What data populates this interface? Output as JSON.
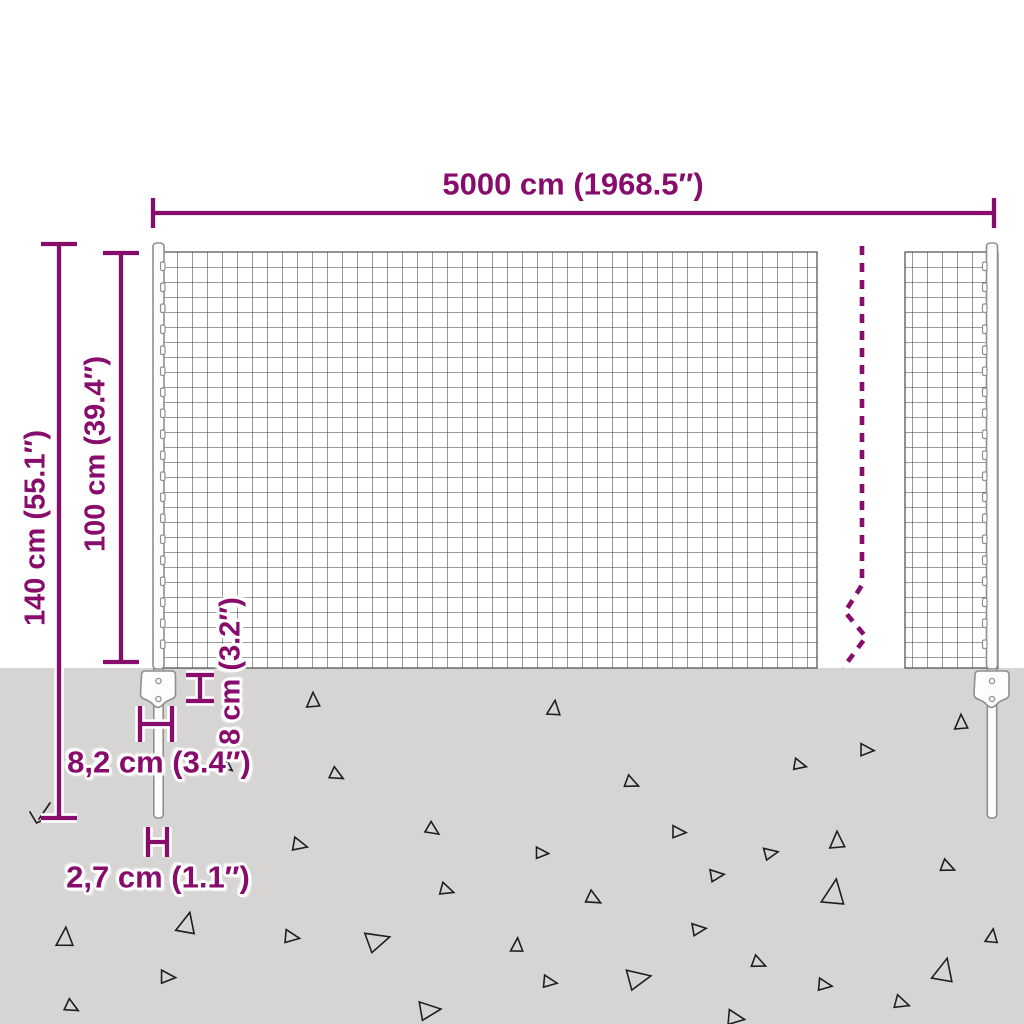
{
  "colors": {
    "accent": "#870c6c",
    "ground": "#d6d5d4",
    "mesh_line": "#3a3a3a",
    "metal_stroke": "#8f8f8f",
    "triangle_stroke": "#1f1f1f"
  },
  "labels": {
    "total_width": "5000 cm (1968.5″)",
    "total_height": "140 cm (55.1″)",
    "above_ground_height": "100 cm (39.4″)",
    "anchor_depth": "8 cm (3.2″)",
    "anchor_plate_width": "8,2 cm (3.4″)",
    "spike_width": "2,7 cm (1.1″)"
  },
  "ground": {
    "triangles": [
      {
        "x": 313,
        "y": 700,
        "s": 14,
        "r": 0
      },
      {
        "x": 554,
        "y": 708,
        "s": 14,
        "r": 8
      },
      {
        "x": 961,
        "y": 722,
        "s": 14,
        "r": 0
      },
      {
        "x": 867,
        "y": 750,
        "s": 13,
        "r": 95
      },
      {
        "x": 800,
        "y": 765,
        "s": 12,
        "r": 105
      },
      {
        "x": 337,
        "y": 775,
        "s": 13,
        "r": 120
      },
      {
        "x": 632,
        "y": 783,
        "s": 13,
        "r": 115
      },
      {
        "x": 228,
        "y": 767,
        "s": 10,
        "r": 130
      },
      {
        "x": 433,
        "y": 830,
        "s": 13,
        "r": 125
      },
      {
        "x": 300,
        "y": 845,
        "s": 14,
        "r": 105
      },
      {
        "x": 679,
        "y": 832,
        "s": 13,
        "r": 95
      },
      {
        "x": 837,
        "y": 840,
        "s": 16,
        "r": 0
      },
      {
        "x": 542,
        "y": 853,
        "s": 12,
        "r": 95
      },
      {
        "x": 771,
        "y": 853,
        "s": 13,
        "r": 80
      },
      {
        "x": 948,
        "y": 867,
        "s": 13,
        "r": 115
      },
      {
        "x": 717,
        "y": 875,
        "s": 13,
        "r": 85
      },
      {
        "x": 594,
        "y": 899,
        "s": 14,
        "r": 120
      },
      {
        "x": 834,
        "y": 892,
        "s": 24,
        "r": 10
      },
      {
        "x": 447,
        "y": 890,
        "s": 13,
        "r": 110
      },
      {
        "x": 187,
        "y": 923,
        "s": 20,
        "r": 15
      },
      {
        "x": 65,
        "y": 937,
        "s": 18,
        "r": 5
      },
      {
        "x": 292,
        "y": 937,
        "s": 14,
        "r": 100
      },
      {
        "x": 378,
        "y": 940,
        "s": 22,
        "r": 75
      },
      {
        "x": 699,
        "y": 929,
        "s": 13,
        "r": 85
      },
      {
        "x": 517,
        "y": 945,
        "s": 13,
        "r": 5
      },
      {
        "x": 992,
        "y": 936,
        "s": 13,
        "r": 10
      },
      {
        "x": 168,
        "y": 977,
        "s": 14,
        "r": 95
      },
      {
        "x": 550,
        "y": 982,
        "s": 13,
        "r": 100
      },
      {
        "x": 639,
        "y": 978,
        "s": 22,
        "r": 80
      },
      {
        "x": 759,
        "y": 963,
        "s": 13,
        "r": 115
      },
      {
        "x": 944,
        "y": 970,
        "s": 22,
        "r": 15
      },
      {
        "x": 825,
        "y": 985,
        "s": 13,
        "r": 100
      },
      {
        "x": 902,
        "y": 1003,
        "s": 14,
        "r": 110
      },
      {
        "x": 72,
        "y": 1007,
        "s": 13,
        "r": 120
      },
      {
        "x": 430,
        "y": 1010,
        "s": 20,
        "r": 85
      },
      {
        "x": 736,
        "y": 1018,
        "s": 16,
        "r": 100
      }
    ]
  }
}
